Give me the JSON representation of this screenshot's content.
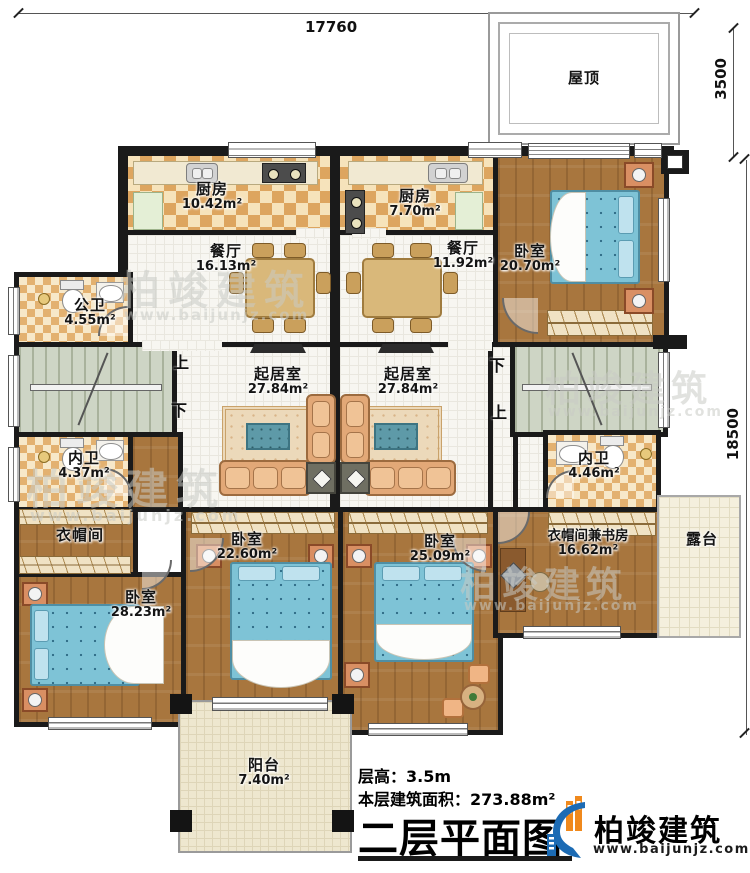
{
  "dimensions": {
    "top": "17760",
    "roof_right": "3500",
    "right_side": "18500"
  },
  "rooms": [
    {
      "name": "厨房",
      "area": "10.42m²"
    },
    {
      "name": "厨房",
      "area": "7.70m²"
    },
    {
      "name": "餐厅",
      "area": "16.13m²"
    },
    {
      "name": "餐厅",
      "area": "11.92m²"
    },
    {
      "name": "卧室",
      "area": "20.70m²"
    },
    {
      "name": "公卫",
      "area": "4.55m²"
    },
    {
      "name": "起居室",
      "area": "27.84m²"
    },
    {
      "name": "起居室",
      "area": "27.84m²"
    },
    {
      "name": "内卫",
      "area": "4.37m²"
    },
    {
      "name": "内卫",
      "area": "4.46m²"
    },
    {
      "name": "衣帽间",
      "area": ""
    },
    {
      "name": "卧室",
      "area": "28.23m²"
    },
    {
      "name": "卧室",
      "area": "22.60m²"
    },
    {
      "name": "卧室",
      "area": "25.09m²"
    },
    {
      "name": "衣帽间兼书房",
      "area": "16.62m²"
    },
    {
      "name": "露台",
      "area": ""
    },
    {
      "name": "阳台",
      "area": "7.40m²"
    },
    {
      "name": "屋顶",
      "area": ""
    }
  ],
  "stairs": {
    "up": "上",
    "down": "下"
  },
  "info": {
    "floor_height": "层高：3.5m",
    "floor_area": "本层建筑面积：273.88m²",
    "title": "二层平面图"
  },
  "brand": {
    "name": "柏竣建筑",
    "url": "www.baijunjz.com"
  },
  "watermark": {
    "text": "柏竣建筑",
    "url": "www.baijunjz.com"
  }
}
